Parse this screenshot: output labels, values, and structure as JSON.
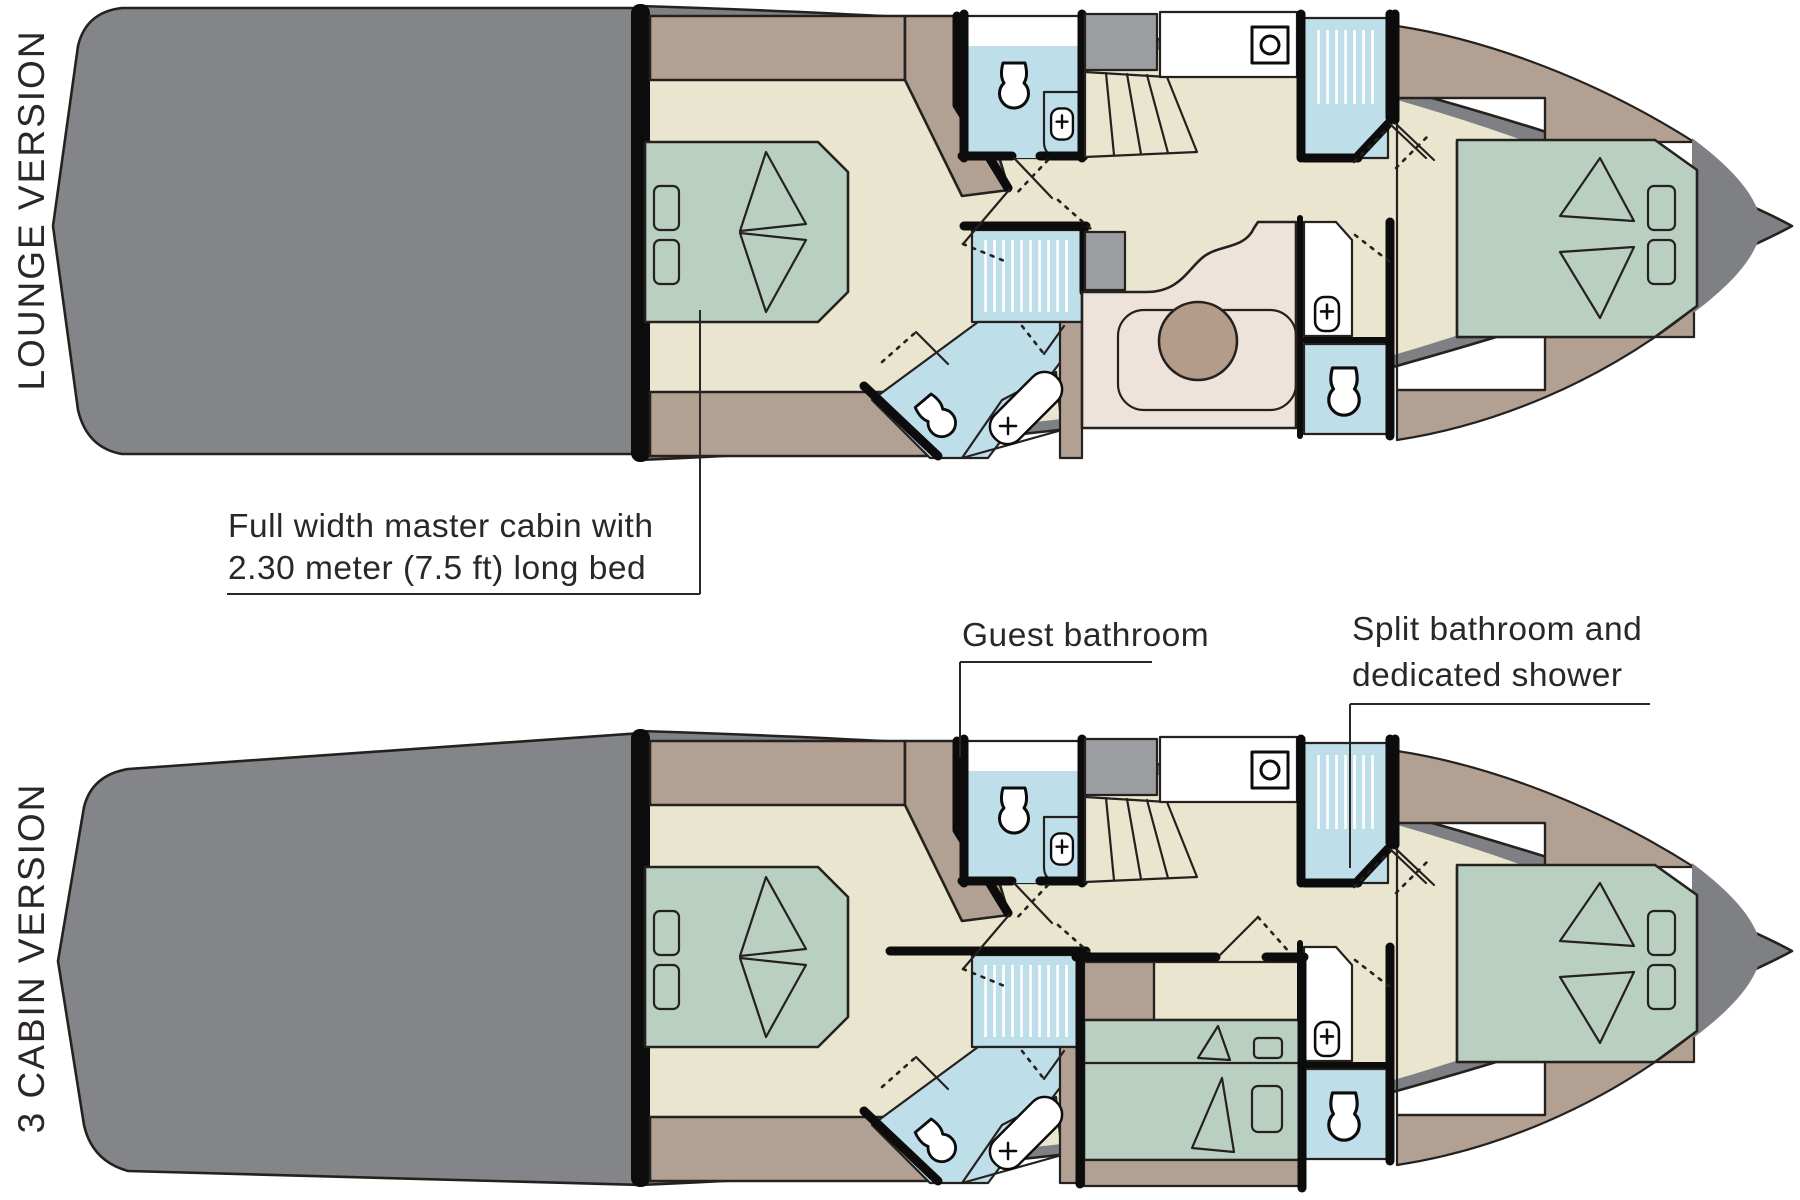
{
  "plans": [
    {
      "label": "LOUNGE VERSION"
    },
    {
      "label": "3 CABIN VERSION"
    }
  ],
  "annotations": {
    "master_cabin": {
      "line1": "Full width master cabin with",
      "line2": "2.30 meter (7.5 ft) long bed"
    },
    "guest_bathroom": {
      "text": "Guest bathroom"
    },
    "split_bathroom": {
      "line1": "Split bathroom and",
      "line2": "dedicated shower"
    }
  },
  "colors": {
    "outline": "#25211f",
    "wall": "#0c0c0c",
    "hull": "#7e8083",
    "platform": "#848588",
    "floor": "#eae5cf",
    "wood": "#b2a193",
    "bed": "#b9cfc2",
    "bath": "#bedfe9",
    "sofa": "#eee3db",
    "sofa_inner": "#f4eee8",
    "table": "#b49c8a",
    "cabinet": "#9b9da0",
    "text": "#2b2727"
  }
}
